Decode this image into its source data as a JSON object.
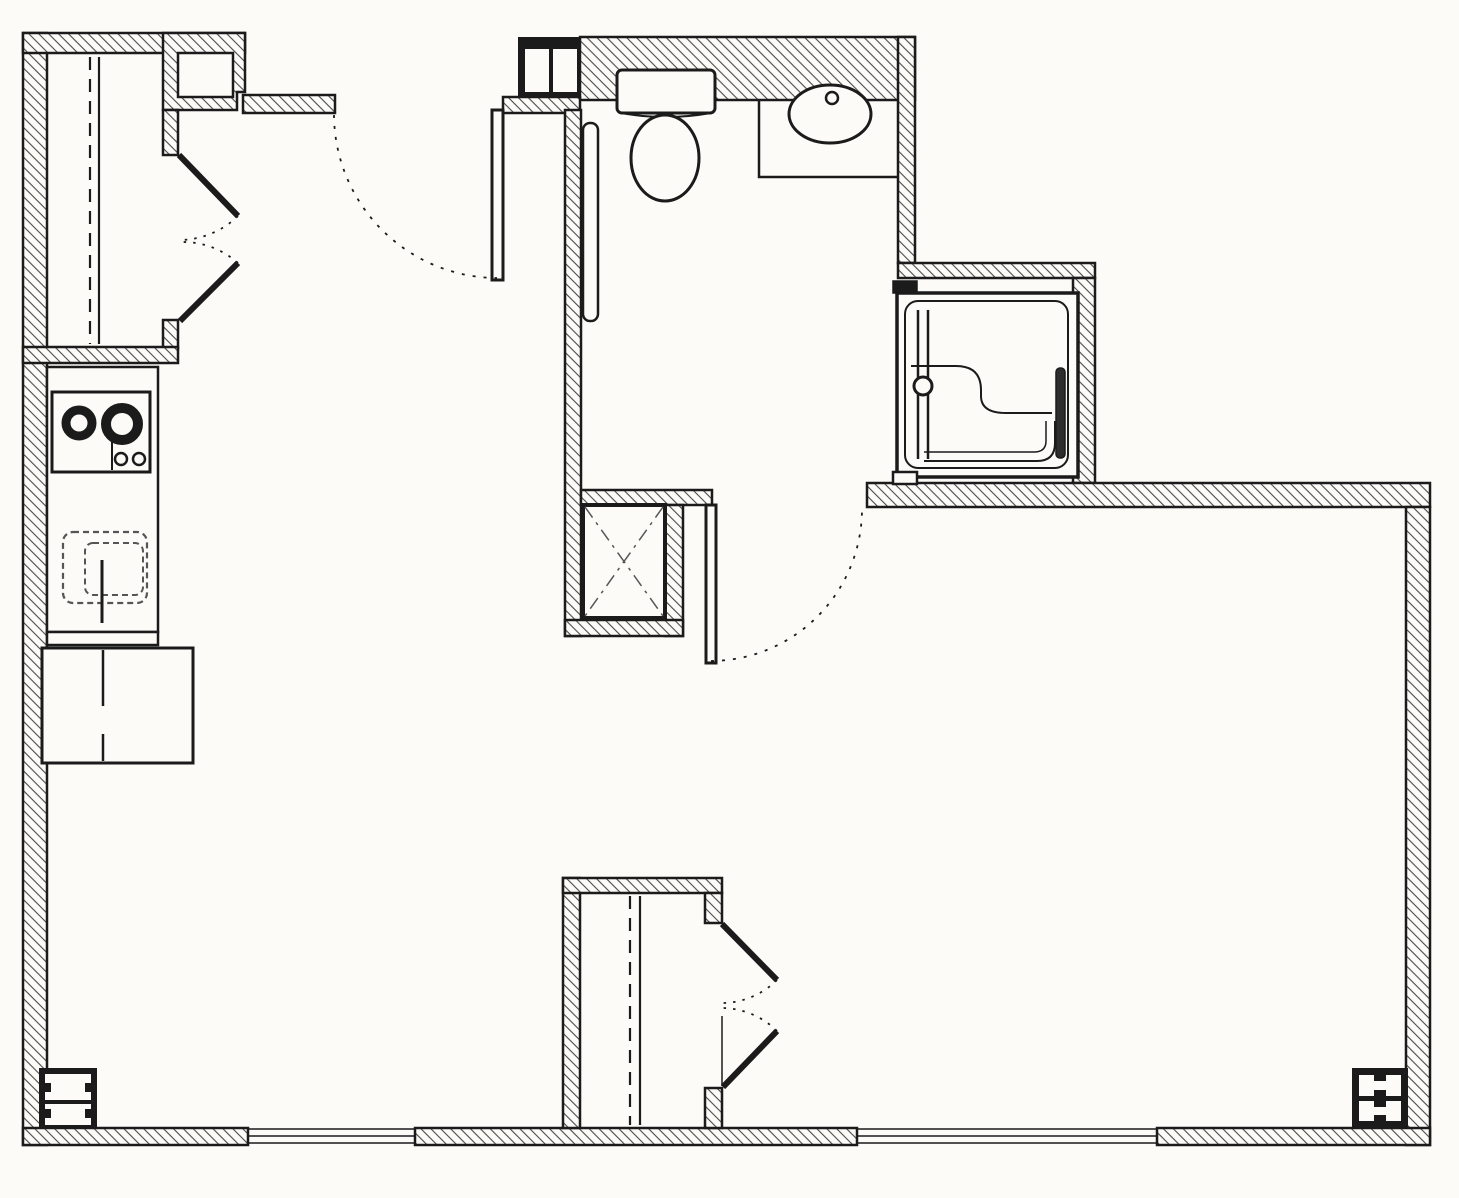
{
  "drawing_type": "apartment-floor-plan",
  "canvas": {
    "width": 1459,
    "height": 1198
  },
  "colors": {
    "background": "#fcfbf8",
    "line": "#1b1b1b",
    "hatch": "#4a4a4a",
    "soft": "#555555",
    "dark_fill": "#2e2e2e"
  },
  "rooms": [
    {
      "name": "room-upper-closet",
      "x": 47,
      "y": 53,
      "w": 116,
      "h": 294
    },
    {
      "name": "room-entry-vestibule",
      "x": 250,
      "y": 113,
      "w": 315,
      "h": 375
    },
    {
      "name": "room-kitchen",
      "x": 47,
      "y": 363,
      "w": 111,
      "h": 282
    },
    {
      "name": "room-bathroom",
      "x": 581,
      "y": 100,
      "w": 317,
      "h": 390
    },
    {
      "name": "room-shower-alcove",
      "x": 897,
      "y": 283,
      "w": 176,
      "h": 194
    },
    {
      "name": "room-mechanical-chase",
      "x": 583,
      "y": 505,
      "w": 82,
      "h": 113
    },
    {
      "name": "room-lower-closet",
      "x": 580,
      "y": 893,
      "w": 125,
      "h": 235
    },
    {
      "name": "room-living-area",
      "x": 250,
      "y": 505,
      "w": 1156,
      "h": 623
    }
  ],
  "elements": [
    {
      "name": "wall-left",
      "kind": "rect",
      "x": 23,
      "y": 33,
      "w": 24,
      "h": 1112,
      "fill": "hatch",
      "sw": 2.5
    },
    {
      "name": "wall-upper-closet-top",
      "kind": "rect",
      "x": 23,
      "y": 33,
      "w": 222,
      "h": 20,
      "fill": "hatch",
      "sw": 2.5
    },
    {
      "name": "wall-upper-closet-right-block",
      "kind": "poly",
      "points": [
        [
          163,
          33
        ],
        [
          245,
          33
        ],
        [
          245,
          92
        ],
        [
          237,
          92
        ],
        [
          237,
          110
        ],
        [
          163,
          110
        ]
      ],
      "fill": "hatch",
      "sw": 2.5
    },
    {
      "name": "wall-notch-recess",
      "kind": "rect",
      "x": 178,
      "y": 53,
      "w": 55,
      "h": 44,
      "fill": "bg",
      "sw": 2.5
    },
    {
      "name": "wall-vestibule-top-band",
      "kind": "rect",
      "x": 243,
      "y": 95,
      "w": 92,
      "h": 18,
      "fill": "hatch",
      "sw": 2.5
    },
    {
      "name": "wall-upper-closet-jamb-top",
      "kind": "rect",
      "x": 163,
      "y": 110,
      "w": 15,
      "h": 45,
      "fill": "hatch",
      "sw": 2.5
    },
    {
      "name": "wall-upper-closet-jamb-bottom",
      "kind": "rect",
      "x": 163,
      "y": 320,
      "w": 15,
      "h": 28,
      "fill": "hatch",
      "sw": 2.5
    },
    {
      "name": "wall-upper-closet-bottom",
      "kind": "rect",
      "x": 23,
      "y": 347,
      "w": 155,
      "h": 16,
      "fill": "hatch",
      "sw": 2.5
    },
    {
      "name": "wall-top-main",
      "kind": "rect",
      "x": 580,
      "y": 37,
      "w": 335,
      "h": 63,
      "fill": "hatch",
      "sw": 2.5
    },
    {
      "name": "wall-entry-jamb-band",
      "kind": "rect",
      "x": 503,
      "y": 97,
      "w": 77,
      "h": 16,
      "fill": "hatch",
      "sw": 2.5
    },
    {
      "name": "wall-bathroom-left",
      "kind": "rect",
      "x": 565,
      "y": 110,
      "w": 16,
      "h": 526,
      "fill": "hatch",
      "sw": 2.5
    },
    {
      "name": "wall-bathroom-south-left",
      "kind": "rect",
      "x": 581,
      "y": 490,
      "w": 131,
      "h": 15,
      "fill": "hatch",
      "sw": 2.5
    },
    {
      "name": "wall-chase-right",
      "kind": "rect",
      "x": 665,
      "y": 505,
      "w": 18,
      "h": 131,
      "fill": "hatch",
      "sw": 2.5
    },
    {
      "name": "wall-chase-bottom",
      "kind": "rect",
      "x": 565,
      "y": 620,
      "w": 118,
      "h": 16,
      "fill": "hatch",
      "sw": 2.5
    },
    {
      "name": "wall-bathroom-right",
      "kind": "rect",
      "x": 898,
      "y": 37,
      "w": 17,
      "h": 226,
      "fill": "hatch",
      "sw": 2.5
    },
    {
      "name": "wall-shower-top",
      "kind": "rect",
      "x": 898,
      "y": 263,
      "w": 197,
      "h": 15,
      "fill": "hatch",
      "sw": 2.5
    },
    {
      "name": "wall-shower-right",
      "kind": "rect",
      "x": 1073,
      "y": 278,
      "w": 22,
      "h": 205,
      "fill": "hatch",
      "sw": 2.5
    },
    {
      "name": "wall-south-right-segment",
      "kind": "rect",
      "x": 867,
      "y": 483,
      "w": 563,
      "h": 24,
      "fill": "hatch",
      "sw": 2.5
    },
    {
      "name": "wall-right",
      "kind": "rect",
      "x": 1406,
      "y": 507,
      "w": 24,
      "h": 638,
      "fill": "hatch",
      "sw": 2.5
    },
    {
      "name": "wall-bottom-1",
      "kind": "rect",
      "x": 23,
      "y": 1128,
      "w": 225,
      "h": 17,
      "fill": "hatch",
      "sw": 2.5
    },
    {
      "name": "wall-bottom-2",
      "kind": "rect",
      "x": 415,
      "y": 1128,
      "w": 442,
      "h": 17,
      "fill": "hatch",
      "sw": 2.5
    },
    {
      "name": "wall-bottom-3",
      "kind": "rect",
      "x": 1157,
      "y": 1128,
      "w": 273,
      "h": 17,
      "fill": "hatch",
      "sw": 2.5
    },
    {
      "name": "wall-lower-closet-left",
      "kind": "rect",
      "x": 563,
      "y": 878,
      "w": 17,
      "h": 250,
      "fill": "hatch",
      "sw": 2.5
    },
    {
      "name": "wall-lower-closet-top",
      "kind": "rect",
      "x": 563,
      "y": 878,
      "w": 159,
      "h": 15,
      "fill": "hatch",
      "sw": 2.5
    },
    {
      "name": "wall-lower-closet-jamb-top",
      "kind": "rect",
      "x": 705,
      "y": 893,
      "w": 17,
      "h": 30,
      "fill": "hatch",
      "sw": 2.5
    },
    {
      "name": "wall-lower-closet-jamb-bottom",
      "kind": "rect",
      "x": 705,
      "y": 1088,
      "w": 17,
      "h": 40,
      "fill": "hatch",
      "sw": 2.5
    },
    {
      "name": "entry-column-frame",
      "kind": "rect",
      "x": 518,
      "y": 37,
      "w": 62,
      "h": 60,
      "fill": "black"
    },
    {
      "name": "entry-column-cell-left",
      "kind": "rect",
      "x": 525,
      "y": 49,
      "w": 24,
      "h": 43,
      "fill": "bg"
    },
    {
      "name": "entry-column-cell-right",
      "kind": "rect",
      "x": 553,
      "y": 49,
      "w": 24,
      "h": 43,
      "fill": "bg"
    },
    {
      "name": "corner-column-sw-frame",
      "kind": "rect",
      "x": 39,
      "y": 1068,
      "w": 58,
      "h": 60,
      "fill": "black"
    },
    {
      "name": "corner-column-sw-cell-1",
      "kind": "rect",
      "x": 45,
      "y": 1074,
      "w": 46,
      "h": 26,
      "fill": "bg"
    },
    {
      "name": "corner-column-sw-cell-2",
      "kind": "rect",
      "x": 45,
      "y": 1104,
      "w": 46,
      "h": 21,
      "fill": "bg"
    },
    {
      "name": "corner-column-sw-notch-1",
      "kind": "rect",
      "x": 45,
      "y": 1083,
      "w": 6,
      "h": 9,
      "fill": "black"
    },
    {
      "name": "corner-column-sw-notch-2",
      "kind": "rect",
      "x": 85,
      "y": 1083,
      "w": 6,
      "h": 9,
      "fill": "black"
    },
    {
      "name": "corner-column-sw-notch-3",
      "kind": "rect",
      "x": 45,
      "y": 1109,
      "w": 6,
      "h": 9,
      "fill": "black"
    },
    {
      "name": "corner-column-sw-notch-4",
      "kind": "rect",
      "x": 85,
      "y": 1109,
      "w": 6,
      "h": 9,
      "fill": "black"
    },
    {
      "name": "corner-column-se-frame",
      "kind": "rect",
      "x": 1352,
      "y": 1068,
      "w": 56,
      "h": 59,
      "fill": "black"
    },
    {
      "name": "corner-column-se-cell-1",
      "kind": "rect",
      "x": 1359,
      "y": 1075,
      "w": 42,
      "h": 21,
      "fill": "bg"
    },
    {
      "name": "corner-column-se-cell-2",
      "kind": "rect",
      "x": 1359,
      "y": 1101,
      "w": 42,
      "h": 20,
      "fill": "bg"
    },
    {
      "name": "corner-column-se-notch-1",
      "kind": "rect",
      "x": 1374,
      "y": 1075,
      "w": 12,
      "h": 6,
      "fill": "black"
    },
    {
      "name": "corner-column-se-notch-2",
      "kind": "rect",
      "x": 1374,
      "y": 1090,
      "w": 12,
      "h": 6,
      "fill": "black"
    },
    {
      "name": "corner-column-se-notch-3",
      "kind": "rect",
      "x": 1374,
      "y": 1101,
      "w": 12,
      "h": 6,
      "fill": "black"
    },
    {
      "name": "corner-column-se-notch-4",
      "kind": "rect",
      "x": 1374,
      "y": 1115,
      "w": 12,
      "h": 6,
      "fill": "black"
    },
    {
      "name": "upper-closet-rod-line",
      "kind": "line",
      "x1": 90,
      "y1": 57,
      "x2": 90,
      "y2": 344,
      "sw": 2.2,
      "dash": "13 9"
    },
    {
      "name": "upper-closet-shelf-line",
      "kind": "line",
      "x1": 99,
      "y1": 57,
      "x2": 99,
      "y2": 344,
      "sw": 2.2
    },
    {
      "name": "upper-closet-door-leaf-1",
      "kind": "line",
      "x1": 179,
      "y1": 155,
      "x2": 238,
      "y2": 216,
      "sw": 6
    },
    {
      "name": "upper-closet-door-leaf-2",
      "kind": "line",
      "x1": 180,
      "y1": 321,
      "x2": 238,
      "y2": 263,
      "sw": 6
    },
    {
      "name": "upper-closet-door-swing-1",
      "kind": "path",
      "d": "M 238 216 A 85 85 0 0 1 181 240",
      "sw": 1.8,
      "dash": "2.5 7"
    },
    {
      "name": "upper-closet-door-swing-2",
      "kind": "path",
      "d": "M 238 263 A 83 83 0 0 0 181 242",
      "sw": 1.8,
      "dash": "2.5 7"
    },
    {
      "name": "entry-door-leaf",
      "kind": "rect",
      "x": 492,
      "y": 110,
      "w": 11,
      "h": 170,
      "fill": "bg",
      "sw": 3
    },
    {
      "name": "entry-door-swing",
      "kind": "path",
      "d": "M 334 115 A 164 164 0 0 0 497 278",
      "sw": 1.8,
      "dash": "3 8"
    },
    {
      "name": "kitchen-counter",
      "kind": "rect",
      "x": 47,
      "y": 367,
      "w": 111,
      "h": 265,
      "fill": "bg",
      "sw": 2.5
    },
    {
      "name": "kitchen-counter-end-cap",
      "kind": "rect",
      "x": 47,
      "y": 632,
      "w": 111,
      "h": 13,
      "fill": "bg",
      "sw": 2.5
    },
    {
      "name": "kitchen-cooktop",
      "kind": "rect",
      "x": 52,
      "y": 392,
      "w": 98,
      "h": 80,
      "fill": "bg",
      "sw": 3
    },
    {
      "name": "cooktop-divider-line",
      "kind": "line",
      "x1": 112,
      "y1": 436,
      "x2": 112,
      "y2": 470,
      "sw": 2
    },
    {
      "name": "cooktop-burner-left",
      "kind": "circle",
      "cx": 79,
      "cy": 423,
      "r": 13,
      "fill": "none",
      "sw": 9
    },
    {
      "name": "cooktop-burner-right",
      "kind": "circle",
      "cx": 122,
      "cy": 424,
      "r": 16,
      "fill": "none",
      "sw": 10
    },
    {
      "name": "cooktop-knob-1",
      "kind": "circle",
      "cx": 121,
      "cy": 459,
      "r": 6,
      "fill": "bg",
      "sw": 2.5
    },
    {
      "name": "cooktop-knob-2",
      "kind": "circle",
      "cx": 139,
      "cy": 459,
      "r": 6,
      "fill": "bg",
      "sw": 2.5
    },
    {
      "name": "kitchen-sink-outline",
      "kind": "rect",
      "x": 63,
      "y": 532,
      "w": 84,
      "h": 71,
      "r": 10,
      "fill": "none",
      "sw": 2.2,
      "stroke": "soft",
      "dash": "6 4"
    },
    {
      "name": "kitchen-sink-basin",
      "kind": "rect",
      "x": 85,
      "y": 543,
      "w": 58,
      "h": 52,
      "r": 8,
      "fill": "none",
      "sw": 2,
      "stroke": "soft",
      "dash": "6 4"
    },
    {
      "name": "kitchen-sink-faucet-line",
      "kind": "line",
      "x1": 102,
      "y1": 560,
      "x2": 102,
      "y2": 623,
      "sw": 3
    },
    {
      "name": "refrigerator",
      "kind": "rect",
      "x": 42,
      "y": 648,
      "w": 151,
      "h": 115,
      "fill": "bg",
      "sw": 3
    },
    {
      "name": "refrigerator-door-split",
      "kind": "line",
      "x1": 103,
      "y1": 650,
      "x2": 103,
      "y2": 706,
      "sw": 2.5
    },
    {
      "name": "refrigerator-handle-line",
      "kind": "line",
      "x1": 103,
      "y1": 734,
      "x2": 103,
      "y2": 761,
      "sw": 2.5
    },
    {
      "name": "bathroom-grab-bar",
      "kind": "rect",
      "x": 583,
      "y": 123,
      "w": 15,
      "h": 198,
      "r": 7,
      "fill": "bg",
      "sw": 2.5
    },
    {
      "name": "toilet-tank",
      "kind": "rect",
      "x": 617,
      "y": 70,
      "w": 98,
      "h": 43,
      "r": 5,
      "fill": "bg",
      "sw": 3
    },
    {
      "name": "toilet-tank-front-curve",
      "kind": "path",
      "d": "M 621 113 Q 666 121 711 113",
      "sw": 2
    },
    {
      "name": "toilet-bowl",
      "kind": "ellipse",
      "cx": 665,
      "cy": 158,
      "rx": 34,
      "ry": 43,
      "fill": "bg",
      "sw": 3
    },
    {
      "name": "vanity-counter-edge",
      "kind": "path",
      "d": "M 759 100 L 759 177 L 898 177",
      "sw": 2.5,
      "fill": "none"
    },
    {
      "name": "vanity-sink-bowl",
      "kind": "ellipse",
      "cx": 830,
      "cy": 114,
      "rx": 41,
      "ry": 29,
      "fill": "bg",
      "sw": 3
    },
    {
      "name": "vanity-faucet",
      "kind": "circle",
      "cx": 832,
      "cy": 98,
      "r": 6,
      "fill": "bg",
      "sw": 2.5
    },
    {
      "name": "chase-box",
      "kind": "rect",
      "x": 583,
      "y": 505,
      "w": 82,
      "h": 113,
      "fill": "bg",
      "sw": 4
    },
    {
      "name": "chase-x-diagonal-1",
      "kind": "line",
      "x1": 585,
      "y1": 507,
      "x2": 663,
      "y2": 616,
      "sw": 1.5,
      "stroke": "soft",
      "dash": "13 6 3 6"
    },
    {
      "name": "chase-x-diagonal-2",
      "kind": "line",
      "x1": 663,
      "y1": 507,
      "x2": 585,
      "y2": 616,
      "sw": 1.5,
      "stroke": "soft",
      "dash": "13 6 3 6"
    },
    {
      "name": "bathroom-door-leaf",
      "kind": "rect",
      "x": 706,
      "y": 505,
      "w": 10,
      "h": 158,
      "fill": "bg",
      "sw": 3
    },
    {
      "name": "bathroom-door-swing",
      "kind": "path",
      "d": "M 711 661 A 152 152 0 0 0 862 509",
      "sw": 1.8,
      "dash": "3 8"
    },
    {
      "name": "shower-stall",
      "kind": "rect",
      "x": 897,
      "y": 293,
      "w": 181,
      "h": 184,
      "fill": "bg",
      "sw": 3.5
    },
    {
      "name": "shower-pan-inner",
      "kind": "rect",
      "x": 905,
      "y": 301,
      "w": 163,
      "h": 167,
      "r": 13,
      "fill": "none",
      "sw": 2
    },
    {
      "name": "shower-seat-curve",
      "kind": "path",
      "d": "M 911 366 L 956 366 Q 981 366 981 390 L 981 396 Q 981 413 1006 413 L 1052 413",
      "sw": 2
    },
    {
      "name": "shower-rim-outer",
      "kind": "path",
      "d": "M 924 461 L 1037 461 Q 1055 461 1055 443 L 1055 421",
      "sw": 2
    },
    {
      "name": "shower-rim-inner",
      "kind": "path",
      "d": "M 924 452 L 1034 452 Q 1046 452 1046 441 L 1046 421",
      "sw": 1.5
    },
    {
      "name": "shower-grab-bar",
      "kind": "rect",
      "x": 1056,
      "y": 368,
      "w": 9,
      "h": 90,
      "r": 4,
      "fill": "dark",
      "sw": 1.5
    },
    {
      "name": "shower-door-track-1",
      "kind": "line",
      "x1": 918,
      "y1": 310,
      "x2": 918,
      "y2": 459,
      "sw": 2.5
    },
    {
      "name": "shower-door-track-2",
      "kind": "line",
      "x1": 928,
      "y1": 310,
      "x2": 928,
      "y2": 459,
      "sw": 2.5
    },
    {
      "name": "shower-door-knob",
      "kind": "circle",
      "cx": 923,
      "cy": 386,
      "r": 9,
      "fill": "bg",
      "sw": 3
    },
    {
      "name": "shower-wall-stub-top",
      "kind": "rect",
      "x": 893,
      "y": 281,
      "w": 24,
      "h": 12,
      "fill": "black",
      "sw": 1.5
    },
    {
      "name": "shower-wall-stub-bottom",
      "kind": "rect",
      "x": 893,
      "y": 472,
      "w": 24,
      "h": 12,
      "fill": "bg",
      "sw": 2.5
    },
    {
      "name": "lower-closet-rod-line",
      "kind": "line",
      "x1": 630,
      "y1": 896,
      "x2": 630,
      "y2": 1125,
      "sw": 2.2,
      "dash": "13 9"
    },
    {
      "name": "lower-closet-shelf-line",
      "kind": "line",
      "x1": 640,
      "y1": 896,
      "x2": 640,
      "y2": 1125,
      "sw": 2.2
    },
    {
      "name": "lower-closet-door-leaf-1",
      "kind": "line",
      "x1": 722,
      "y1": 924,
      "x2": 777,
      "y2": 980,
      "sw": 6
    },
    {
      "name": "lower-closet-door-swing-1",
      "kind": "path",
      "d": "M 777 980 A 79 79 0 0 1 722 1003",
      "sw": 1.8,
      "dash": "2.5 7"
    },
    {
      "name": "lower-closet-door-leaf-2",
      "kind": "line",
      "x1": 777,
      "y1": 1031,
      "x2": 723,
      "y2": 1087,
      "sw": 6
    },
    {
      "name": "lower-closet-door-swing-2",
      "kind": "path",
      "d": "M 777 1031 A 79 79 0 0 0 722 1008",
      "sw": 1.8,
      "dash": "2.5 7"
    },
    {
      "name": "lower-closet-door-closed-line",
      "kind": "line",
      "x1": 722,
      "y1": 1016,
      "x2": 722,
      "y2": 1086,
      "sw": 1.5
    },
    {
      "name": "window-south-left-line-1",
      "kind": "line",
      "x1": 248,
      "y1": 1129,
      "x2": 415,
      "y2": 1129,
      "sw": 1.6
    },
    {
      "name": "window-south-left-line-2",
      "kind": "line",
      "x1": 248,
      "y1": 1136,
      "x2": 415,
      "y2": 1136,
      "sw": 1.6
    },
    {
      "name": "window-south-left-line-3",
      "kind": "line",
      "x1": 248,
      "y1": 1143,
      "x2": 415,
      "y2": 1143,
      "sw": 1.6
    },
    {
      "name": "window-south-right-line-1",
      "kind": "line",
      "x1": 857,
      "y1": 1129,
      "x2": 1157,
      "y2": 1129,
      "sw": 1.6
    },
    {
      "name": "window-south-right-line-2",
      "kind": "line",
      "x1": 857,
      "y1": 1136,
      "x2": 1157,
      "y2": 1136,
      "sw": 1.6
    },
    {
      "name": "window-south-right-line-3",
      "kind": "line",
      "x1": 857,
      "y1": 1143,
      "x2": 1157,
      "y2": 1143,
      "sw": 1.6
    }
  ]
}
